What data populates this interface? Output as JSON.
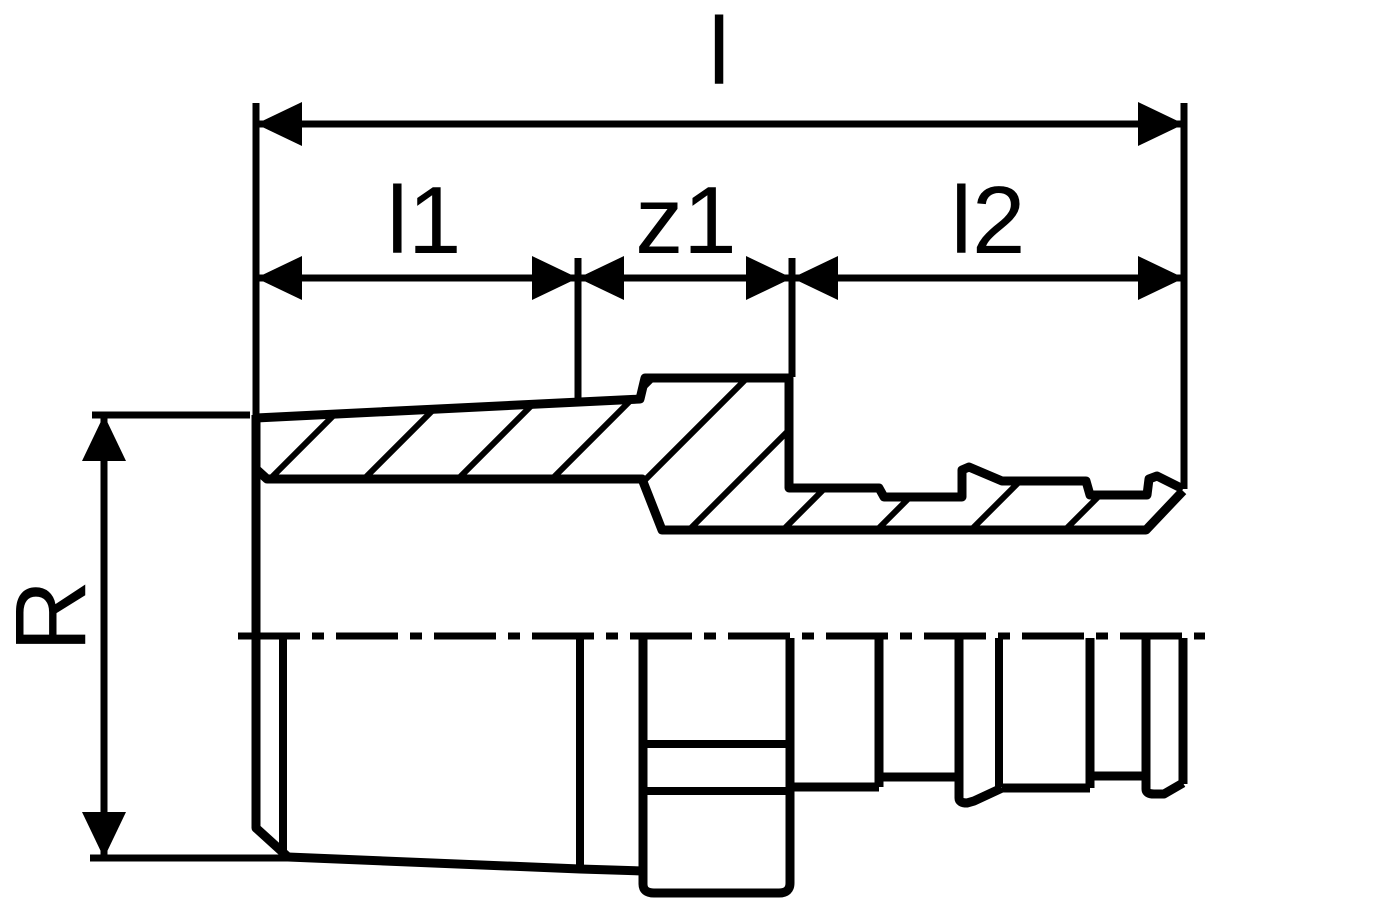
{
  "drawing": {
    "background": "#ffffff",
    "line_color": "#000000",
    "labels": {
      "overall_length": "l",
      "thread_length": "l1",
      "engagement": "z1",
      "press_length": "l2",
      "thread_size": "R"
    }
  }
}
